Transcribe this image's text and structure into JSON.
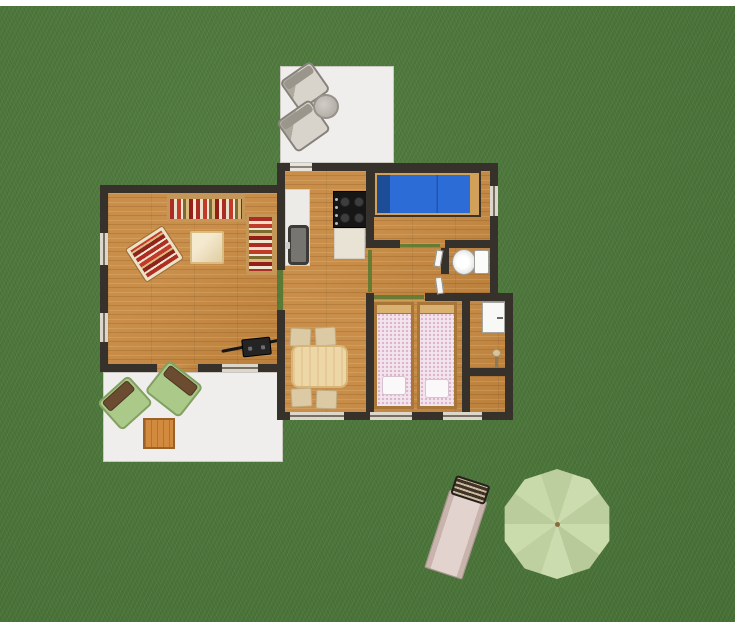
{
  "scene": {
    "title": "Top-down 2D floor plan render of a small house with garden",
    "colors": {
      "grass": "#4c783a",
      "wall": "#36312b",
      "wood_floor": "#c6883f",
      "terrace_floor": "#efeeec",
      "double_bed_mattress": "#2b6cd6",
      "double_bed_pillow": "#1d4d97",
      "twin_bed_spread": "#f2e6ee",
      "sofa_red": "#b02d23",
      "sofa_cream": "#ece2c8",
      "sofa_olive": "#7d6a30",
      "door_threshold_green": "#5d7a31",
      "parasol_green": "#c6d8a6",
      "lounger_beige": "#d8c2bc",
      "garden_chair_green": "#abc989"
    },
    "rooms": {
      "terrace_top": {
        "label": "upper terrace with two garden chairs and a round table"
      },
      "living": {
        "label": "living room with striped sofas, armchair, coffee table and wood stove"
      },
      "kitchen": {
        "label": "kitchen with counter, sink and cooker"
      },
      "dining": {
        "label": "dining area with table and four chairs"
      },
      "bedroom_double": {
        "label": "bedroom with blue double bed"
      },
      "hallway": {
        "label": "hallway with interior doors"
      },
      "bathroom": {
        "label": "bathroom with toilet"
      },
      "bedroom_twin": {
        "label": "bedroom with two single beds"
      },
      "utility": {
        "label": "utility room with wall cabinet and lamp"
      },
      "storage": {
        "label": "small storage room"
      },
      "terrace_bottom": {
        "label": "lower terrace with two green armchairs and a wooden table"
      },
      "garden": {
        "label": "garden lawn with sun lounger and parasol"
      }
    },
    "furniture": {
      "sofa_long": "long striped sofa",
      "sofa_short": "short striped sofa",
      "armchair": "striped armchair",
      "coffee_table": "square coffee table",
      "wood_stove": "wood-burning stove with flue pipe",
      "kitchen_counter": "kitchen counter",
      "kitchen_sink": "kitchen sink",
      "kitchen_stove": "four-burner cooker",
      "dining_table": "dining table",
      "dining_chair": "dining chair",
      "double_bed": "double bed with blue bedding",
      "toilet": "toilet",
      "single_bed": "single bed with dotted bedspread and pillow",
      "wall_cabinet": "white wall cabinet",
      "floor_lamp": "small floor lamp",
      "patio_chair": "gray garden chair",
      "patio_table_round": "round garden table",
      "green_chair": "green garden armchair with brown cushion",
      "patio_table_square": "square wooden garden table",
      "sun_lounger": "sun lounger",
      "parasol": "garden parasol"
    }
  }
}
